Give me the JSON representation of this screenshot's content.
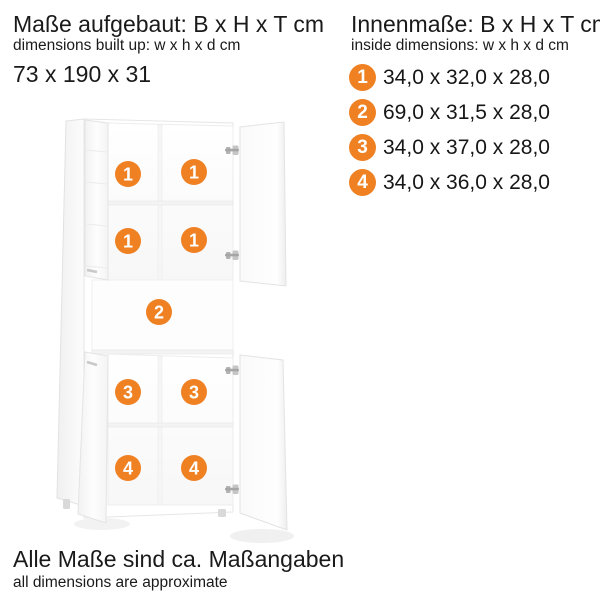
{
  "built_dimensions": {
    "title": "Maße aufgebaut: B x H x T cm",
    "subtitle": "dimensions built up: w x h x d cm",
    "value": "73 x 190 x 31"
  },
  "inside_dimensions": {
    "title": "Innenmaße: B x H x T cm",
    "subtitle": "inside dimensions: w x h x d cm",
    "items": [
      {
        "num": "1",
        "dims": "34,0 x 32,0 x 28,0"
      },
      {
        "num": "2",
        "dims": "69,0 x 31,5 x 28,0"
      },
      {
        "num": "3",
        "dims": "34,0 x 37,0 x 28,0"
      },
      {
        "num": "4",
        "dims": "34,0 x 36,0 x 28,0"
      }
    ]
  },
  "cabinet": {
    "markers": [
      {
        "label": "1"
      },
      {
        "label": "1"
      },
      {
        "label": "1"
      },
      {
        "label": "1"
      },
      {
        "label": "2"
      },
      {
        "label": "3"
      },
      {
        "label": "3"
      },
      {
        "label": "4"
      },
      {
        "label": "4"
      }
    ]
  },
  "footer": {
    "note": "Alle Maße sind ca. Maßangaben",
    "note_en": "all dimensions are approximate"
  },
  "colors": {
    "accent_orange": "#EF8123",
    "marker_text": "#FFFFFF",
    "text": "#1A1A1A"
  }
}
